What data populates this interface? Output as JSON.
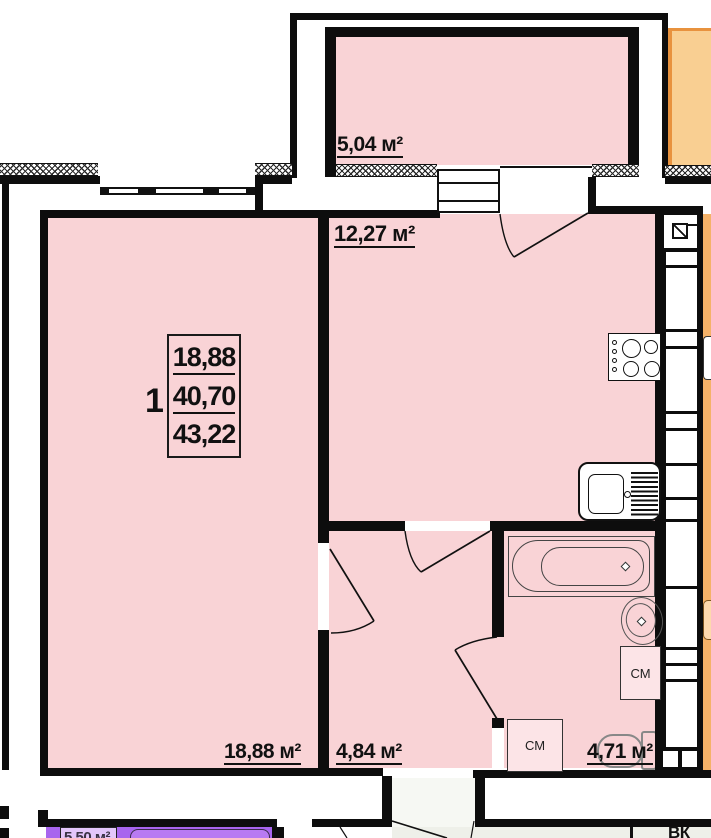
{
  "plan": {
    "info_box": {
      "rooms_count": "1",
      "living_area": "18,88",
      "area": "40,70",
      "total_area": "43,22"
    },
    "room_labels": {
      "balcony": "5,04 м²",
      "kitchen": "12,27 м²",
      "living_room": "18,88 м²",
      "hallway": "4,84 м²",
      "bathroom": "4,71 м²"
    },
    "appliance_labels": {
      "washing_machine_bathroom": "СМ",
      "washing_machine_corner": "СМ"
    },
    "other_labels": {
      "vent_chamber": "ВК",
      "lower_apartment_partial": "5,50 м²"
    },
    "colors": {
      "room_fill": "#f9d3d6",
      "appliance_fill": "#fce4e7",
      "neighbor_fill": "#f5b268",
      "neighbor_balcony_fill": "#f9cf92",
      "neighbor_accent": "#e8923e",
      "lower_apartment_fill": "#a865ee",
      "lower_apartment_light": "#e3c6fa",
      "corridor_fill": "#eef0e9",
      "wall": "#0d0d0d"
    }
  }
}
